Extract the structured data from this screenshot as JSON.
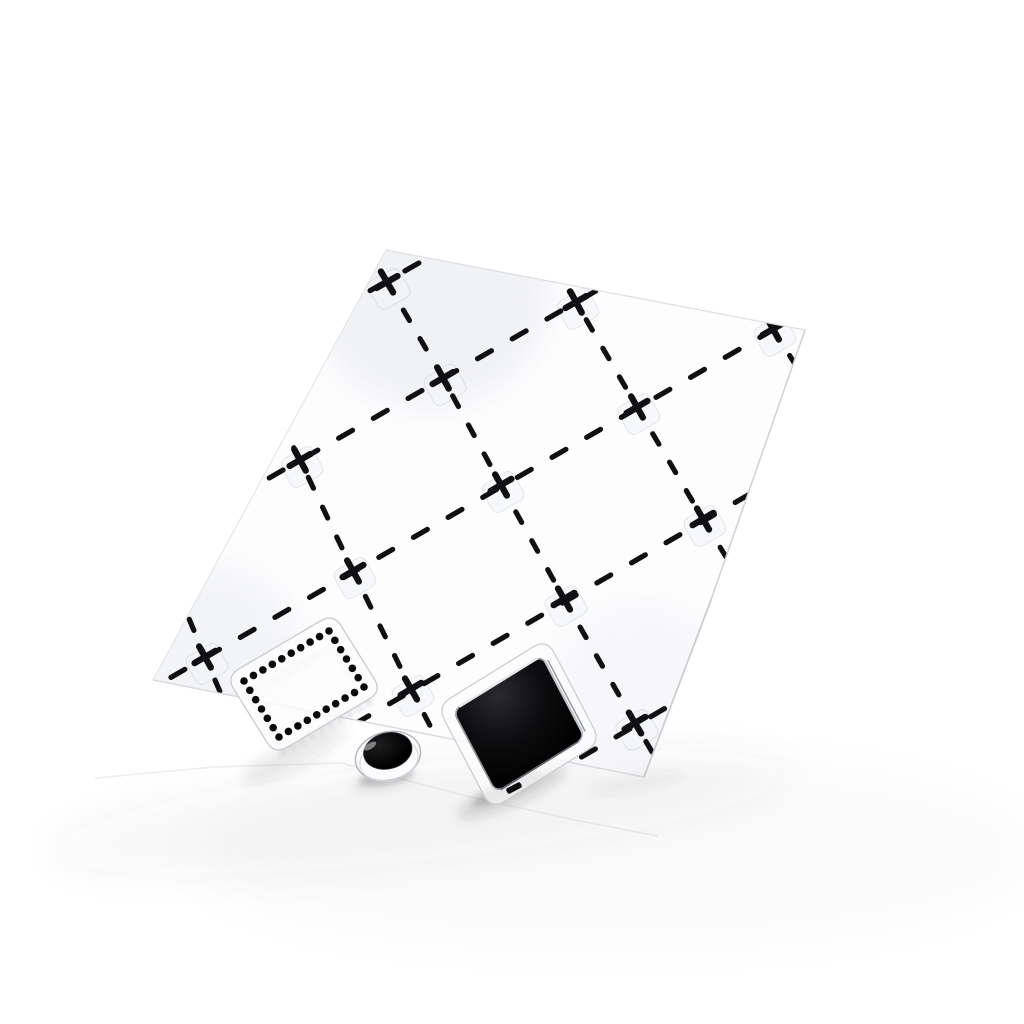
{
  "meta": {
    "description": "Product photo of a transparent clear-stamp set: acrylic sheet printed with a dashed diamond lattice and plus marks, plus a dotted-square stamp, a small solid dot stamp and a solid black square stamp resting near its lower edge on a white surface",
    "background_color": "#ffffff",
    "ink_color": "#101012"
  },
  "canvas": {
    "width": 1024,
    "height": 1024
  },
  "sheet": {
    "polygon": [
      [
        386,
        250
      ],
      [
        805,
        330
      ],
      [
        711,
        600
      ],
      [
        644,
        777
      ],
      [
        153,
        680
      ]
    ],
    "fill": "rgba(252,252,254,0.55)",
    "edges": [
      {
        "from": 0,
        "to": 1,
        "color": "#dcdde2",
        "width": 1.3,
        "opacity": 0.9
      },
      {
        "from": 1,
        "to": 2,
        "color": "#cfd1d7",
        "width": 1.6,
        "opacity": 0.95
      },
      {
        "from": 2,
        "to": 3,
        "color": "#c9cbd1",
        "width": 1.8,
        "opacity": 0.95
      },
      {
        "from": 3,
        "to": 4,
        "color": "#d5d6db",
        "width": 1.5,
        "opacity": 0.9
      },
      {
        "from": 4,
        "to": 0,
        "color": "#e2e3e8",
        "width": 1.2,
        "opacity": 0.85
      }
    ],
    "sheen_spots": [
      {
        "x": 430,
        "y": 290,
        "r": 120,
        "opacity": 0.3
      },
      {
        "x": 215,
        "y": 650,
        "r": 85,
        "opacity": 0.25
      },
      {
        "x": 640,
        "y": 690,
        "r": 90,
        "opacity": 0.16
      }
    ],
    "sheen_color": "#d8dbe3"
  },
  "lattice": {
    "origin": [
      387,
      282
    ],
    "cum_v": [
      [
        0,
        0
      ],
      [
        56,
        96
      ],
      [
        114,
        203
      ],
      [
        177,
        317
      ],
      [
        248,
        441
      ],
      [
        326,
        573
      ]
    ],
    "w_pos": [
      [
        -138,
        78
      ],
      [
        -143,
        82
      ],
      [
        -148,
        86
      ],
      [
        -153,
        90
      ],
      [
        -158,
        93
      ]
    ],
    "w_neg": [
      [
        130,
        -74
      ],
      [
        133,
        -76
      ],
      [
        136,
        -78
      ],
      [
        139,
        -80
      ],
      [
        142,
        -82
      ]
    ],
    "b_pre_ext": [
      50,
      86
    ],
    "b_range": [
      -2,
      2
    ],
    "c_extent": 3.4,
    "plus_rows": [
      [
        0,
        [
          0
        ]
      ],
      [
        1,
        [
          -1,
          0,
          1
        ]
      ],
      [
        2,
        [
          -2,
          -1,
          0,
          1,
          2
        ]
      ],
      [
        3,
        [
          -1,
          0,
          1
        ]
      ],
      [
        4,
        [
          0
        ]
      ]
    ],
    "stroke_width": 5.2,
    "dash_b": "12 21",
    "dash_c": "16 24",
    "plus_arm": 12,
    "plus_width": 6.4,
    "ghost": {
      "fill": "rgba(243,244,248,0.55)",
      "stroke": "rgba(130,136,148,0.18)",
      "rv": 16,
      "rw": 18,
      "offset": [
        2,
        7
      ]
    }
  },
  "stamps": {
    "dotted_square": {
      "center": [
        304,
        684
      ],
      "half_long": [
        42.5,
        -25
      ],
      "half_short": [
        17.5,
        28
      ],
      "dots_long": 10,
      "dots_short": 7,
      "dot_radius": 3.8,
      "dot_color": "#0a0a0b",
      "backing_grow": 13,
      "backing_radius": 15,
      "backing_stroke": "#cdced5",
      "backing_fill": "rgba(252,252,254,0.82)",
      "shadow_dot_offset": [
        4,
        15
      ],
      "shadow_dot_color": "rgba(70,72,80,0.12)"
    },
    "dot_circle": {
      "center": [
        388,
        756
      ],
      "rotation": -14,
      "outer_rx": 33,
      "outer_ry": 24,
      "mid_rx": 29.5,
      "mid_ry": 20.5,
      "mid_dy": 4,
      "inner_center": [
        389,
        751
      ],
      "inner_rx": 24.5,
      "inner_ry": 18,
      "fill_center": "#1d1d20",
      "fill_edge": "#000000",
      "backing_stroke": "#b5b8bf",
      "backing_fill": "#fbfbfd",
      "thickness_stroke": "#d6d8dd",
      "highlight": "rgba(255,255,255,0.45)"
    },
    "solid_square": {
      "center": [
        519,
        724
      ],
      "half_long": [
        44.5,
        -27.5
      ],
      "half_short": [
        21.5,
        41
      ],
      "corner_radius": 10,
      "fill_center": "#2a2a2f",
      "fill_mid": "#0d0d0f",
      "fill_edge": "#000000",
      "outline": "#9ba0a7",
      "rim_topleft": "#eaecf0",
      "rim_right_inner": "#c7cad0",
      "rim_right_outer": "#787d84",
      "rim_bottomright": "#53575d",
      "rim_bottomleft": "#8a8f96",
      "backing_grow": 12,
      "backing_radius": 16,
      "backing_stroke": "#ccced4",
      "backing_fill": "rgba(252,252,254,0.7)",
      "tab": {
        "cx": 514,
        "cy": 788,
        "w": 16,
        "h": 6,
        "angle": -28,
        "fill": "#0b0b0c"
      }
    }
  },
  "surface_shadows": [
    {
      "cx": 420,
      "cy": 812,
      "rx": 370,
      "ry": 48,
      "rot": -6,
      "color": "rgba(60,62,70,0.045)",
      "blur": 18
    },
    {
      "cx": 610,
      "cy": 852,
      "rx": 420,
      "ry": 90,
      "rot": 0,
      "color": "rgba(60,62,70,0.018)",
      "blur": 26
    }
  ],
  "stamp_shadows": [
    {
      "cx": 295,
      "cy": 754,
      "rx": 58,
      "ry": 13,
      "rot": -28,
      "color": "rgba(40,42,48,0.10)",
      "blur": 6
    },
    {
      "cx": 386,
      "cy": 777,
      "rx": 27,
      "ry": 7,
      "rot": -10,
      "color": "rgba(30,32,36,0.22)",
      "blur": 3
    },
    {
      "cx": 384,
      "cy": 781,
      "rx": 34,
      "ry": 9,
      "rot": -10,
      "color": "rgba(30,32,36,0.08)",
      "blur": 5
    },
    {
      "cx": 512,
      "cy": 792,
      "rx": 58,
      "ry": 13,
      "rot": -24,
      "color": "rgba(35,37,42,0.16)",
      "blur": 5
    },
    {
      "cx": 507,
      "cy": 789,
      "rx": 38,
      "ry": 8,
      "rot": -24,
      "color": "rgba(25,26,30,0.14)",
      "blur": 3
    },
    {
      "cx": 637,
      "cy": 783,
      "rx": 48,
      "ry": 8,
      "rot": -10,
      "color": "rgba(60,62,70,0.05)",
      "blur": 4
    }
  ],
  "packaging_edges": [
    {
      "points": [
        [
          95,
          778
        ],
        [
          214,
          767
        ],
        [
          345,
          763
        ]
      ],
      "color": "#e3e3e8",
      "width": 1.5,
      "opacity": 0.65
    },
    {
      "points": [
        [
          345,
          764
        ],
        [
          470,
          797
        ],
        [
          575,
          820
        ],
        [
          658,
          836
        ]
      ],
      "color": "#dfdfe5",
      "width": 1.6,
      "opacity": 0.6
    }
  ]
}
